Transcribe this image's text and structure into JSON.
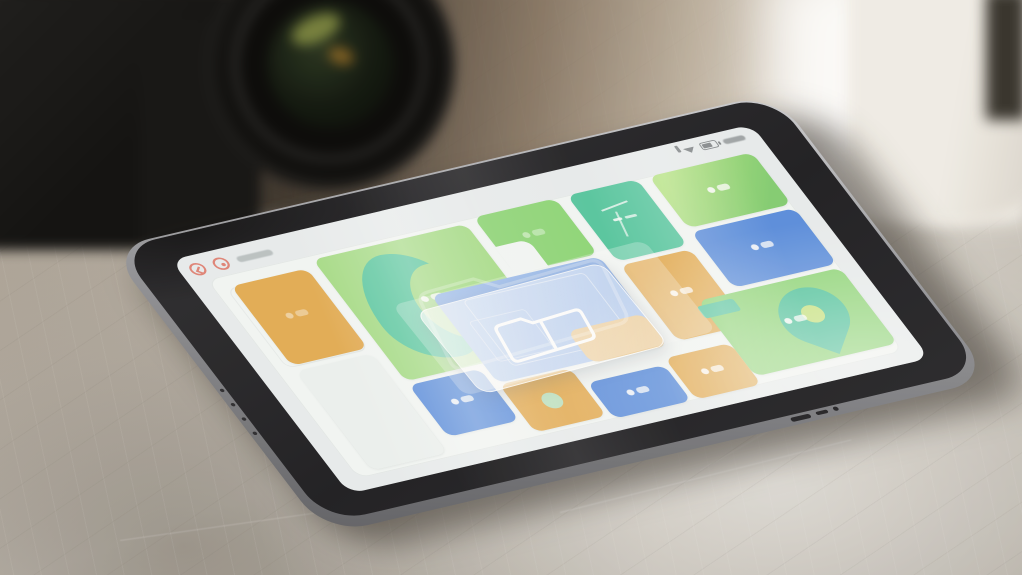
{
  "colors": {
    "orange": "#e4ad55",
    "green": "#8ed778",
    "greenLight": "#a5dd86",
    "greenGrad": "linear-gradient(125deg,#b9e689 10%,#83ce72 85%)",
    "teal": "#57c8a1",
    "blue": "#5a8edf",
    "blueLight": "#7da8ea",
    "light": "#eef3f2",
    "coral": "#df6a5b",
    "panel": "#f4f8f7",
    "screen": "#e9eef0",
    "frame": "#232327",
    "metal": "#97989d",
    "pinFill": "#4cc39d",
    "pinCore": "#c6e57e",
    "table": "#b3aca1"
  },
  "scene": {
    "objects": [
      "camera",
      "coffee-cup",
      "steel-table",
      "tablet"
    ]
  },
  "screen": {
    "toolbar": {
      "icons": [
        {
          "name": "back-icon"
        },
        {
          "name": "record-icon"
        }
      ]
    },
    "statusbar": {
      "icons": [
        "cellular-icon",
        "wifi-icon",
        "battery-icon"
      ]
    },
    "overlay": {
      "icon": "folder-window-icon"
    },
    "tiles": [
      {
        "id": "orange-top-left",
        "color": "orange",
        "x": 3,
        "y": 5,
        "w": 14,
        "h": 40,
        "glyph": "faint"
      },
      {
        "id": "green-large",
        "color": "greenLight",
        "x": 19,
        "y": 2,
        "w": 28,
        "h": 61,
        "feature": "curve",
        "glyph": "pair"
      },
      {
        "id": "green-notched",
        "color": "green",
        "x": 49,
        "y": 0,
        "w": 15,
        "h": 28,
        "feature": "notch",
        "glyph": "faint"
      },
      {
        "id": "teal-top",
        "color": "teal",
        "x": 66,
        "y": 0,
        "w": 13,
        "h": 33,
        "feature": "lineart",
        "glyph": "lineart"
      },
      {
        "id": "green-gradient",
        "color": "greenGrad",
        "x": 81,
        "y": 0,
        "w": 19,
        "h": 26,
        "glyph": "pair"
      },
      {
        "id": "blue-top-right",
        "color": "blue",
        "x": 81,
        "y": 28,
        "w": 19,
        "h": 28,
        "glyph": "pair"
      },
      {
        "id": "blue-center",
        "color": "blueLight",
        "x": 33,
        "y": 29,
        "w": 31,
        "h": 44,
        "feature": "schematic"
      },
      {
        "id": "orange-under-glass",
        "color": "orange",
        "x": 50,
        "y": 58,
        "w": 14,
        "h": 16
      },
      {
        "id": "orange-middle",
        "color": "orange",
        "x": 66,
        "y": 35,
        "w": 13,
        "h": 38,
        "glyph": "pair"
      },
      {
        "id": "green-pin",
        "color": "green",
        "x": 74,
        "y": 58,
        "w": 26,
        "h": 38,
        "feature": "pin",
        "glyph": "pair"
      },
      {
        "id": "blue-small-left",
        "color": "blue",
        "x": 19,
        "y": 65,
        "w": 13,
        "h": 26,
        "glyph": "pair"
      },
      {
        "id": "orange-dot",
        "color": "orange",
        "x": 33,
        "y": 74,
        "w": 13,
        "h": 24,
        "feature": "dot"
      },
      {
        "id": "blue-bottom",
        "color": "blue",
        "x": 47,
        "y": 82,
        "w": 14,
        "h": 18,
        "glyph": "pair"
      },
      {
        "id": "orange-bottom-right",
        "color": "orange",
        "x": 62,
        "y": 79,
        "w": 12,
        "h": 21,
        "glyph": "pair"
      },
      {
        "id": "light-bottom-left",
        "color": "light",
        "x": 3,
        "y": 48,
        "w": 14,
        "h": 50
      }
    ]
  }
}
